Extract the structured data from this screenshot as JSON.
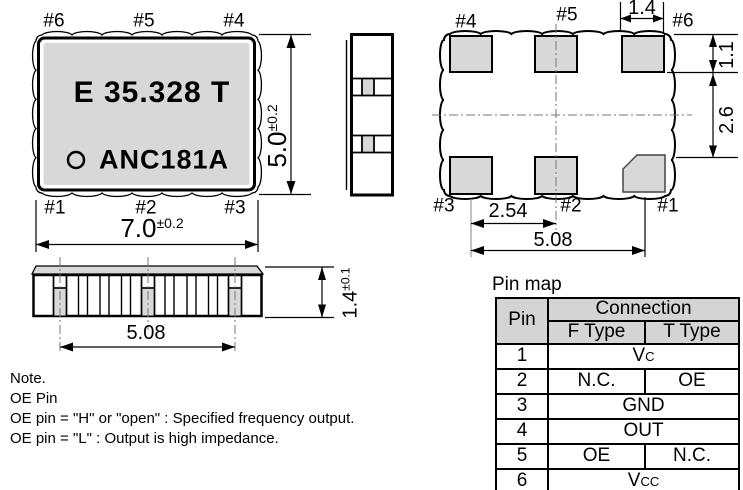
{
  "top_view": {
    "pins_top": [
      "#6",
      "#5",
      "#4"
    ],
    "pins_bottom": [
      "#1",
      "#2",
      "#3"
    ],
    "marking_line1": "E 35.328 T",
    "marking_line2": "ANC181A",
    "dim_width": {
      "value": "7.0",
      "tol": "±0.2"
    },
    "dim_height": {
      "value": "5.0",
      "tol": "±0.2"
    }
  },
  "bottom_view": {
    "pins_top": [
      "#4",
      "#5",
      "#6"
    ],
    "pins_bottom": [
      "#3",
      "#2",
      "#1"
    ],
    "dim_pad_width": "1.4",
    "dim_pad_height": "1.1",
    "dim_row_spacing": "2.6",
    "dim_pad_pitch": "2.54",
    "dim_pad_span": "5.08"
  },
  "side_view": {
    "dim_pad_span": "5.08",
    "dim_height": {
      "value": "1.4",
      "tol": "±0.1"
    }
  },
  "notes": {
    "title": "Note.",
    "line1": "OE Pin",
    "line2": "OE pin = \"H\" or \"open\" : Specified frequency output.",
    "line3": "OE pin = \"L\" : Output is high impedance."
  },
  "pin_map": {
    "title": "Pin map",
    "col_pin": "Pin",
    "col_connection": "Connection",
    "col_f_type": "F Type",
    "col_t_type": "T Type",
    "rows": [
      {
        "pin": "1",
        "connection": "Vc"
      },
      {
        "pin": "2",
        "f": "N.C.",
        "t": "OE"
      },
      {
        "pin": "3",
        "connection": "GND"
      },
      {
        "pin": "4",
        "connection": "OUT"
      },
      {
        "pin": "5",
        "f": "OE",
        "t": "N.C."
      },
      {
        "pin": "6",
        "connection": "Vcc"
      }
    ]
  },
  "colors": {
    "body_fill": "#d8d8d8",
    "pad_fill": "#d8d8d8",
    "header_fill": "#d4d4d4",
    "line": "#000000",
    "centerline": "#777777"
  }
}
